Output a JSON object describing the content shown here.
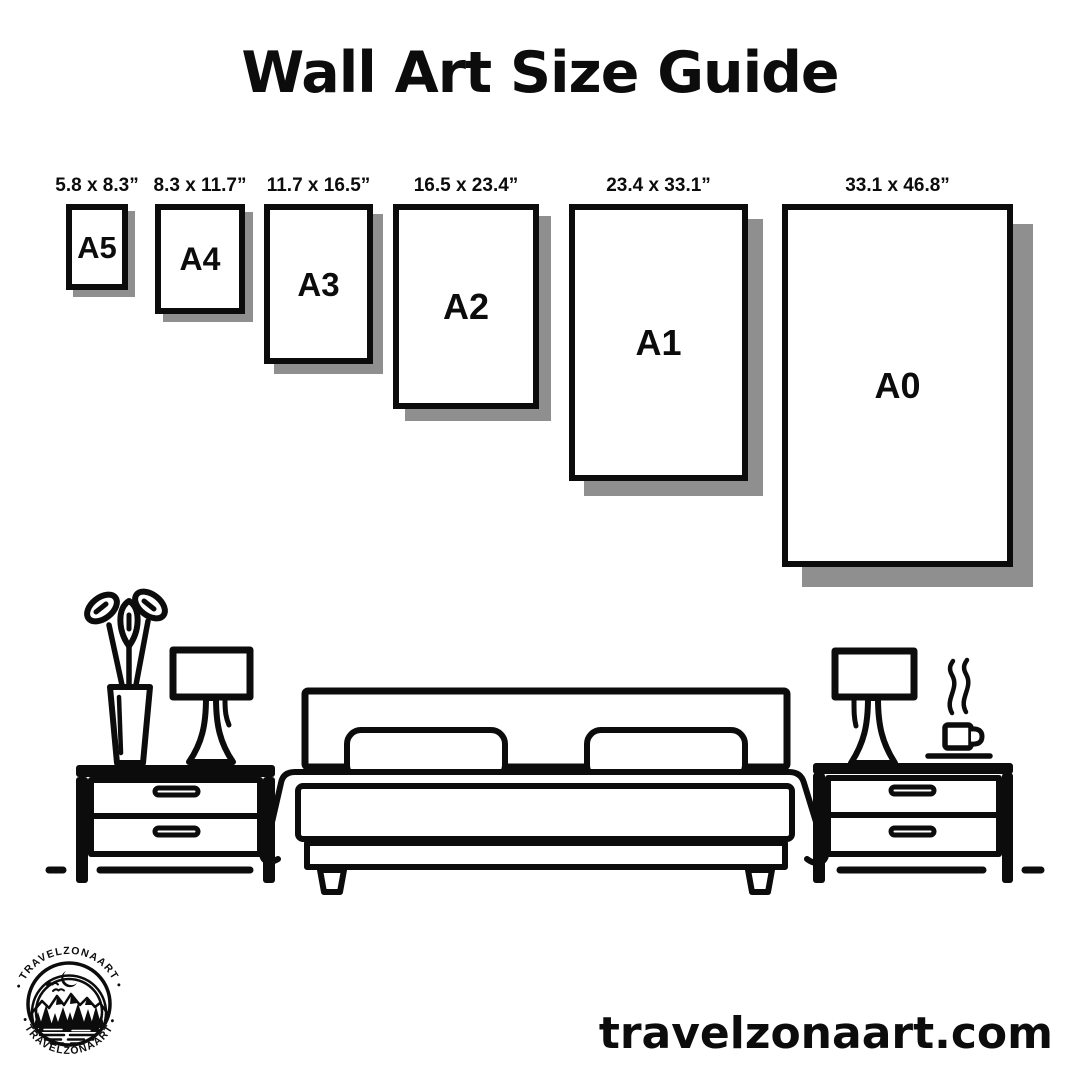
{
  "title": "Wall Art Size Guide",
  "size_guide": {
    "items": [
      {
        "code": "A5",
        "dimensions": "5.8 x 8.3”"
      },
      {
        "code": "A4",
        "dimensions": "8.3 x 11.7”"
      },
      {
        "code": "A3",
        "dimensions": "11.7 x 16.5”"
      },
      {
        "code": "A2",
        "dimensions": "16.5 x 23.4”"
      },
      {
        "code": "A1",
        "dimensions": "23.4 x 33.1”"
      },
      {
        "code": "A0",
        "dimensions": "33.1 x 46.8”"
      }
    ]
  },
  "illustration": {
    "scene": "bedroom line art",
    "elements": [
      "flower-vase",
      "table-lamp-left",
      "nightstand-left",
      "double-bed",
      "pillows",
      "blanket",
      "table-lamp-right",
      "steaming-coffee-cup",
      "nightstand-right",
      "floor-line"
    ]
  },
  "brand": {
    "website": "travelzonaart.com",
    "logo_ring_text_top": "• TRAVELZONAART •",
    "logo_ring_text_bottom": "• TRAVELZONAART •"
  },
  "colors": {
    "ink": "#0c0c0c",
    "background": "#ffffff",
    "shadow": "#8f8f8f"
  }
}
